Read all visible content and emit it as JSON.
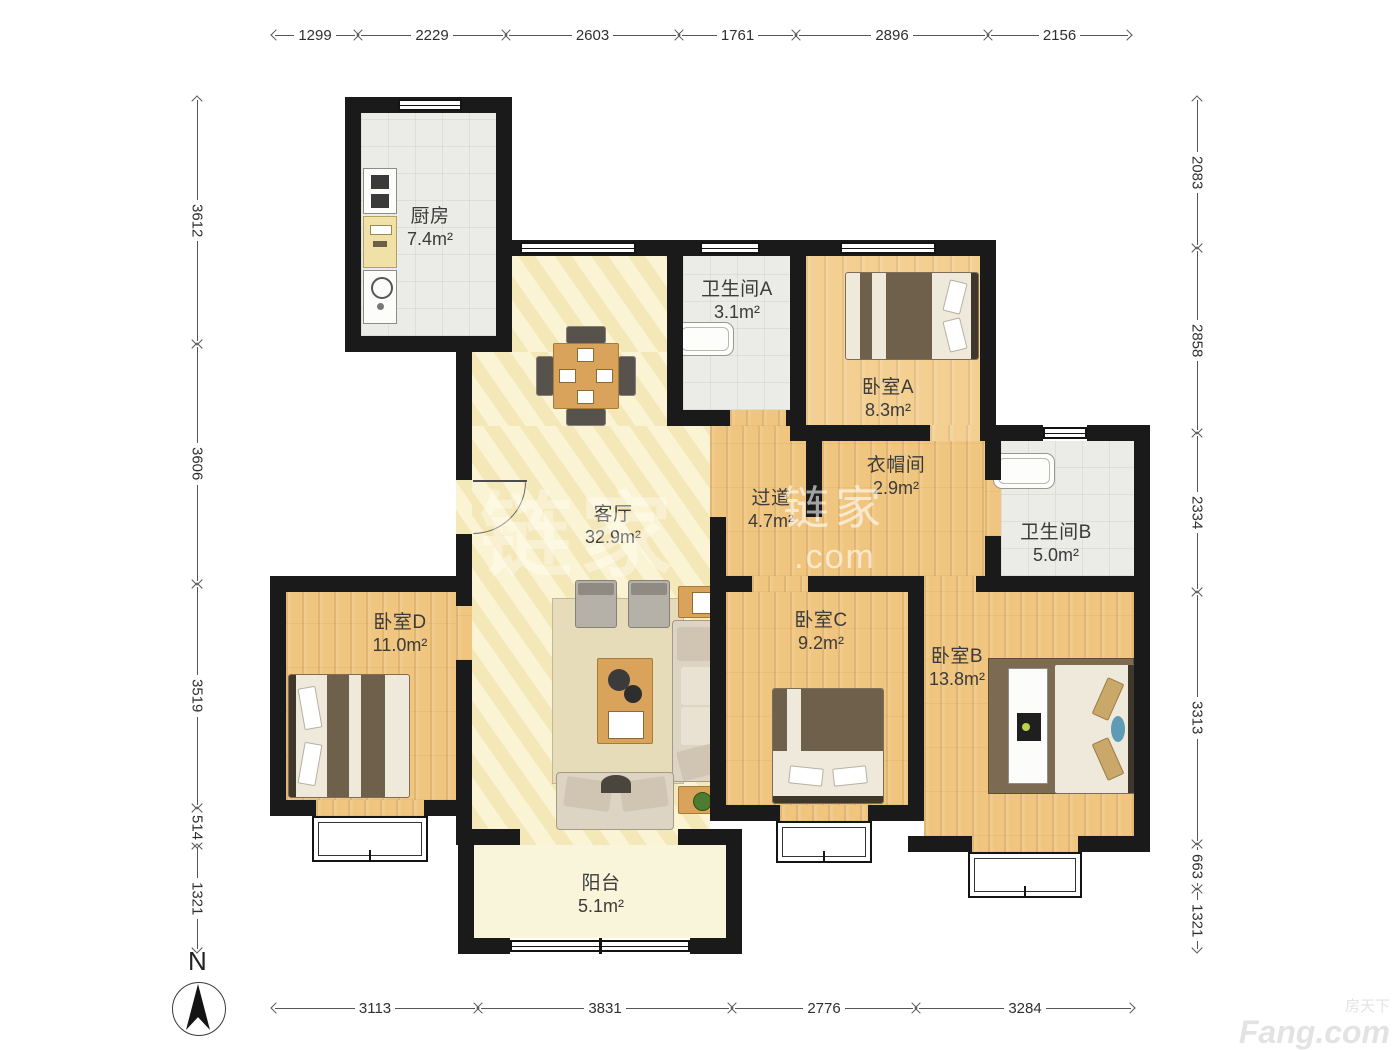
{
  "compass": {
    "label": "N"
  },
  "rooms": [
    {
      "id": "kitchen",
      "name": "厨房",
      "area": "7.4m²"
    },
    {
      "id": "bath_a",
      "name": "卫生间A",
      "area": "3.1m²"
    },
    {
      "id": "bedroom_a",
      "name": "卧室A",
      "area": "8.3m²"
    },
    {
      "id": "cloakroom",
      "name": "衣帽间",
      "area": "2.9m²"
    },
    {
      "id": "bath_b",
      "name": "卫生间B",
      "area": "5.0m²"
    },
    {
      "id": "living",
      "name": "客厅",
      "area": "32.9m²"
    },
    {
      "id": "hallway",
      "name": "过道",
      "area": "4.7m²"
    },
    {
      "id": "bedroom_d",
      "name": "卧室D",
      "area": "11.0m²"
    },
    {
      "id": "bedroom_c",
      "name": "卧室C",
      "area": "9.2m²"
    },
    {
      "id": "bedroom_b",
      "name": "卧室B",
      "area": "13.8m²"
    },
    {
      "id": "balcony",
      "name": "阳台",
      "area": "5.1m²"
    }
  ],
  "dimensions": {
    "top": [
      "1299",
      "2229",
      "2603",
      "1761",
      "2896",
      "2156"
    ],
    "bottom": [
      "3113",
      "3831",
      "2776",
      "3284"
    ],
    "left": [
      "3612",
      "3606",
      "3519",
      "514",
      "1321"
    ],
    "right": [
      "2083",
      "2858",
      "2334",
      "3313",
      "663",
      "1321"
    ]
  },
  "watermarks": {
    "lianjia_cn": "链家",
    "lianjia_suffix": ".com",
    "fang_cn": "房天下",
    "fang_en": "Fang.com"
  },
  "colors": {
    "wall": "#1a1a1a",
    "wood_floor": "#efc57f",
    "wood_floor_light": "#f3cf92",
    "tile_floor": "#ebebe7",
    "living_floor": "#f8f0c6",
    "furniture_accent": "#d9a35b"
  }
}
